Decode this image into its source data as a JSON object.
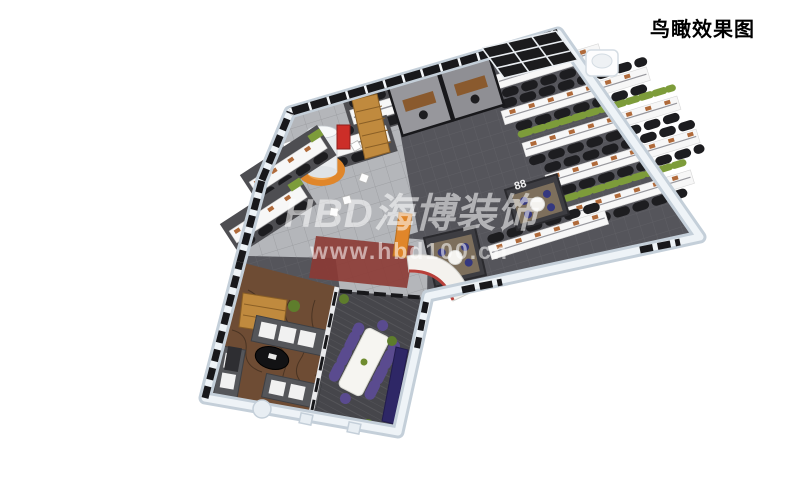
{
  "title": {
    "label": "鸟瞰效果图"
  },
  "watermark": {
    "brand": "HBD海博装饰",
    "url": "www.hbd100.cn"
  },
  "floorplan": {
    "sign_88": "88"
  },
  "colors": {
    "background": "#ffffff",
    "wall-outer": "#c4cfd9",
    "wall-top": "#eef3f7",
    "frame-dark": "#18181b",
    "carpet-office": "#55555b",
    "carpet-meeting": "#46464b",
    "tile-light": "#b4b6ba",
    "floor-lounge": "#6e4c34",
    "floor-room": "#7d6f5c",
    "accent-orange": "#e0862a",
    "accent-red": "#cc2e28",
    "carpet-red": "#8c3a34",
    "wood": "#c08a3e",
    "wood-dark": "#8a5a2e",
    "plant-green": "#7d9c3a",
    "chair-black": "#1d1d20",
    "chair-purple": "#5a4b8f",
    "chair-blue": "#35387f",
    "desk-white": "#f7f7f7",
    "watermark": "rgba(255,255,255,0.55)"
  }
}
